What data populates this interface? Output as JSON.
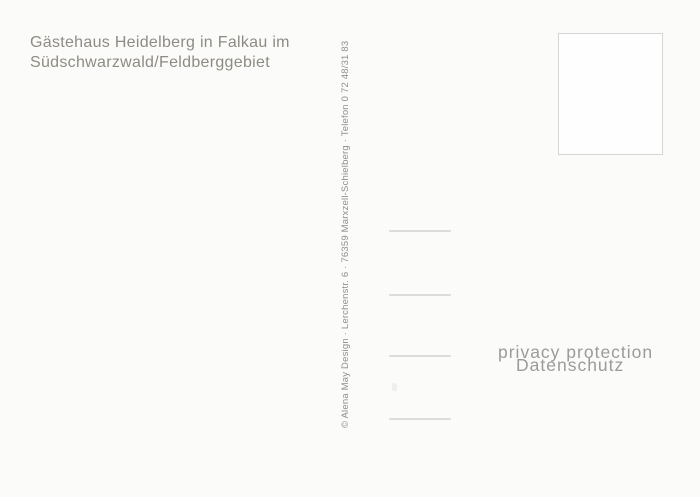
{
  "postcard": {
    "title_line1": "Gästehaus Heidelberg in Falkau im",
    "title_line2": "Südschwarzwald/Feldberggebiet",
    "credit_vertical": "© Alena May Design · Lerchenstr. 6 · 76359 Marxzell-Schielberg · Telefon 0 72 48/31 83",
    "watermark_line1": "privacy protection",
    "watermark_line2": "Datenschutz"
  },
  "colors": {
    "background": "#fbfbfa",
    "title_text": "#8e8b83",
    "credit_text": "#918e86",
    "watermark_text": "#9b9b9b",
    "stamp_border": "#d6d6d4",
    "address_line": "#dcdcda"
  }
}
